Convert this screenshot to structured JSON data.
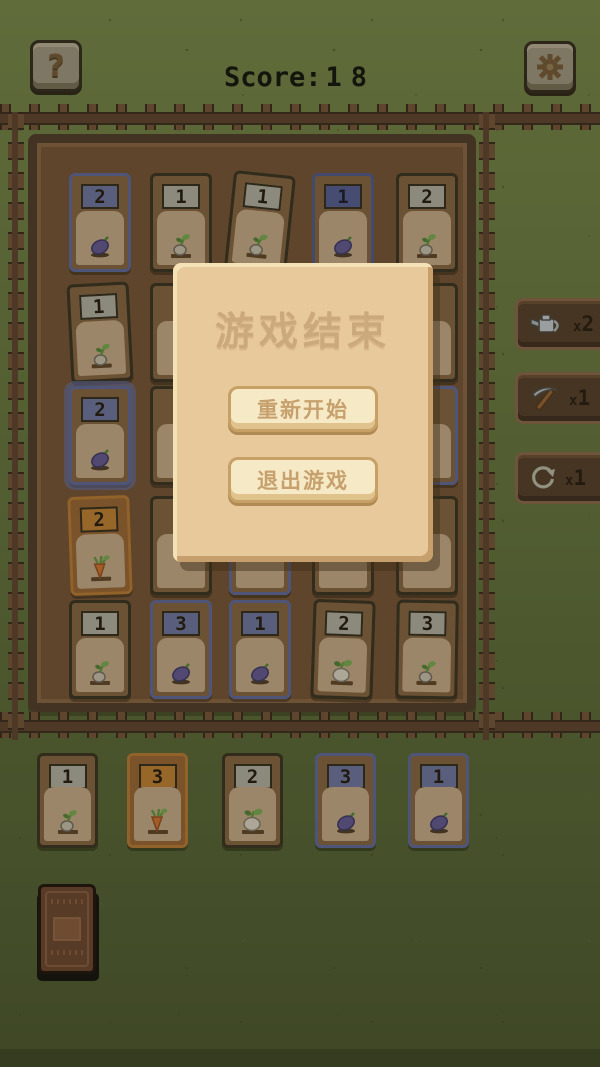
{
  "hud": {
    "score_label": "Score:",
    "score_value": "18",
    "help_glyph": "?"
  },
  "dialog": {
    "title": "游戏结束",
    "restart_label": "重新开始",
    "quit_label": "退出游戏"
  },
  "tools": [
    {
      "name": "watering-can",
      "count_x": "x",
      "count_n": "2"
    },
    {
      "name": "pickaxe",
      "count_x": "x",
      "count_n": "1"
    },
    {
      "name": "refresh",
      "count_x": "x",
      "count_n": "1"
    }
  ],
  "field": {
    "rows": 5,
    "cols": 5,
    "cards": [
      {
        "row": 1,
        "col": 1,
        "value": "2",
        "crop": "eggplant",
        "variant": "blue"
      },
      {
        "row": 1,
        "col": 2,
        "value": "1",
        "crop": "sprout",
        "variant": "gray"
      },
      {
        "row": 1,
        "col": 3,
        "value": "1",
        "crop": "sprout",
        "variant": "gray",
        "tilt": 6
      },
      {
        "row": 1,
        "col": 4,
        "value": "1",
        "crop": "eggplant",
        "variant": "blue-dark"
      },
      {
        "row": 1,
        "col": 5,
        "value": "2",
        "crop": "sprout",
        "variant": "gray"
      },
      {
        "row": 2,
        "col": 1,
        "value": "1",
        "crop": "sprout",
        "variant": "gray",
        "tilt": -3
      },
      {
        "row": 2,
        "col": 2,
        "value": "",
        "crop": "unknown",
        "variant": "gray",
        "covered": true
      },
      {
        "row": 2,
        "col": 3,
        "value": "",
        "crop": "unknown",
        "variant": "gray",
        "covered": true
      },
      {
        "row": 2,
        "col": 4,
        "value": "",
        "crop": "unknown",
        "variant": "gray",
        "covered": true
      },
      {
        "row": 2,
        "col": 5,
        "value": "",
        "crop": "unknown",
        "variant": "gray",
        "covered": true
      },
      {
        "row": 3,
        "col": 1,
        "value": "2",
        "crop": "eggplant",
        "variant": "blue",
        "glow": true
      },
      {
        "row": 3,
        "col": 2,
        "value": "",
        "crop": "unknown",
        "variant": "gray",
        "covered": true
      },
      {
        "row": 3,
        "col": 3,
        "value": "",
        "crop": "unknown",
        "variant": "gray",
        "covered": true
      },
      {
        "row": 3,
        "col": 4,
        "value": "",
        "crop": "unknown",
        "variant": "gray",
        "covered": true
      },
      {
        "row": 3,
        "col": 5,
        "value": "",
        "crop": "unknown",
        "variant": "blue",
        "covered": true
      },
      {
        "row": 4,
        "col": 1,
        "value": "2",
        "crop": "carrot",
        "variant": "orange",
        "tilt": -2
      },
      {
        "row": 4,
        "col": 2,
        "value": "",
        "crop": "unknown",
        "variant": "gray",
        "covered": true
      },
      {
        "row": 4,
        "col": 3,
        "value": "",
        "crop": "unknown",
        "variant": "blue",
        "covered": true
      },
      {
        "row": 4,
        "col": 4,
        "value": "",
        "crop": "unknown",
        "variant": "gray",
        "covered": true
      },
      {
        "row": 4,
        "col": 5,
        "value": "",
        "crop": "unknown",
        "variant": "gray",
        "covered": true
      },
      {
        "row": 5,
        "col": 1,
        "value": "1",
        "crop": "sprout",
        "variant": "gray"
      },
      {
        "row": 5,
        "col": 2,
        "value": "3",
        "crop": "eggplant",
        "variant": "blue"
      },
      {
        "row": 5,
        "col": 3,
        "value": "1",
        "crop": "eggplant",
        "variant": "blue"
      },
      {
        "row": 5,
        "col": 4,
        "value": "2",
        "crop": "turnip",
        "variant": "gray",
        "tilt": 2
      },
      {
        "row": 5,
        "col": 5,
        "value": "3",
        "crop": "sprout",
        "variant": "gray",
        "tilt": 1
      }
    ]
  },
  "hand": [
    {
      "value": "1",
      "crop": "sprout",
      "variant": "gray"
    },
    {
      "value": "3",
      "crop": "carrot",
      "variant": "orange"
    },
    {
      "value": "2",
      "crop": "turnip",
      "variant": "gray"
    },
    {
      "value": "3",
      "crop": "eggplant",
      "variant": "blue"
    },
    {
      "value": "1",
      "crop": "eggplant",
      "variant": "blue"
    }
  ],
  "deck": {
    "name": "draw-pile"
  },
  "colors": {
    "background_green": "#5e6b39",
    "dirt_brown": "#6d4e31",
    "card_brown": "#7d5d3c",
    "card_panel_tan": "#b49b7b",
    "blue_accent": "#59618e",
    "orange_accent": "#a8702f",
    "dialog_tan": "#e7c99b",
    "dialog_button_cream": "#f6e9c6",
    "score_text": "#13160d"
  }
}
